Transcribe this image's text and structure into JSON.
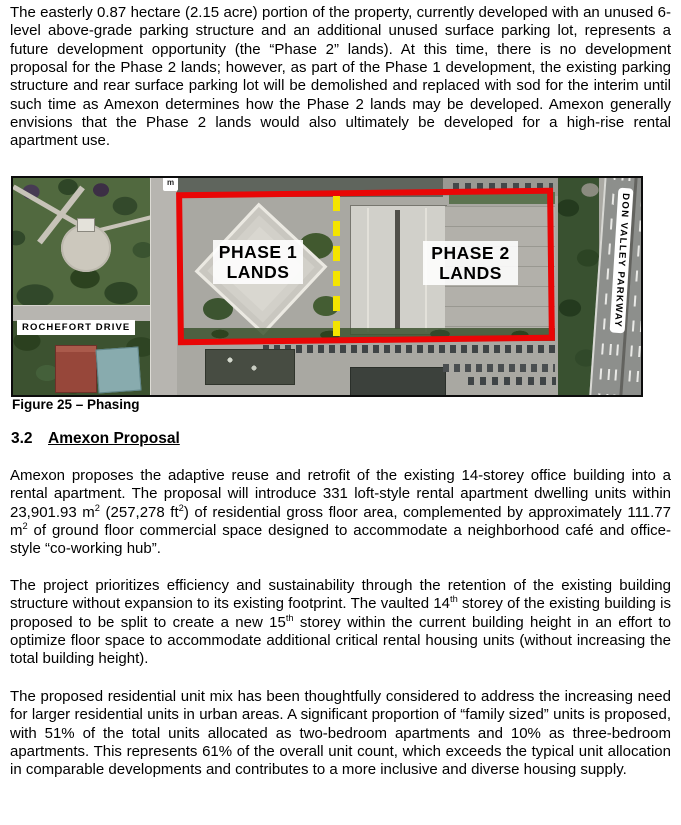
{
  "section": {
    "number": "3.2",
    "title": "Amexon Proposal"
  },
  "figure": {
    "caption": "Figure 25 – Phasing",
    "labels": {
      "phase1_line1": "PHASE 1",
      "phase1_line2": "LANDS",
      "phase2_line1": "PHASE 2",
      "phase2_line2": "LANDS",
      "street_left": "ROCHEFORT DRIVE",
      "street_right": "DON VALLEY PARKWAY",
      "map_marker": "m"
    },
    "colors": {
      "boundary_red": "#e90606",
      "phase_divider_yellow": "#f4e400"
    }
  },
  "paras": {
    "p1": {
      "runs": [
        {
          "t": "The easterly 0.87 hectare (2.15 acre) portion of the property, currently developed with an unused 6-level above-grade parking structure and an additional unused surface parking lot, represents a future development opportunity (the “Phase 2” lands). At this time, there is no development proposal for the Phase 2 lands; however, as part of the Phase 1 development, the existing parking structure and rear surface parking lot will be demolished and replaced with sod for the interim until such time as Amexon determines how the Phase 2 lands may be developed. Amexon generally envisions that the Phase 2 lands would also ultimately be developed for a high-rise rental apartment use."
        }
      ]
    },
    "p2": {
      "runs": [
        {
          "t": "Amexon proposes the adaptive reuse and retrofit of the existing 14-storey office building into a rental apartment. The proposal will introduce 331 loft-style rental apartment dwelling units within 23,901.93 m"
        },
        {
          "t": "2",
          "sup": true
        },
        {
          "t": " (257,278 ft"
        },
        {
          "t": "2",
          "sup": true
        },
        {
          "t": ") of residential gross floor area, complemented by approximately 111.77 m"
        },
        {
          "t": "2",
          "sup": true
        },
        {
          "t": " of ground floor commercial space designed to accommodate a neighborhood café and office-style “co-working hub”."
        }
      ]
    },
    "p3": {
      "runs": [
        {
          "t": "The project prioritizes efficiency and sustainability through the retention of the existing building structure without expansion to its existing footprint. The vaulted 14"
        },
        {
          "t": "th",
          "sup": true
        },
        {
          "t": " storey of the existing building is proposed to be split to create a new 15"
        },
        {
          "t": "th",
          "sup": true
        },
        {
          "t": " storey within the current building height in an effort to optimize floor space to accommodate additional critical rental housing units (without increasing the total building height)."
        }
      ]
    },
    "p4": {
      "runs": [
        {
          "t": "The proposed residential unit mix has been thoughtfully considered to address the increasing need for larger residential units in urban areas. A significant proportion of “family sized” units is proposed, with 51% of the total units allocated as two-bedroom apartments and 10% as three-bedroom apartments. This represents 61% of the overall unit count, which exceeds the typical unit allocation in comparable developments and contributes to a more inclusive and diverse housing supply."
        }
      ]
    }
  }
}
